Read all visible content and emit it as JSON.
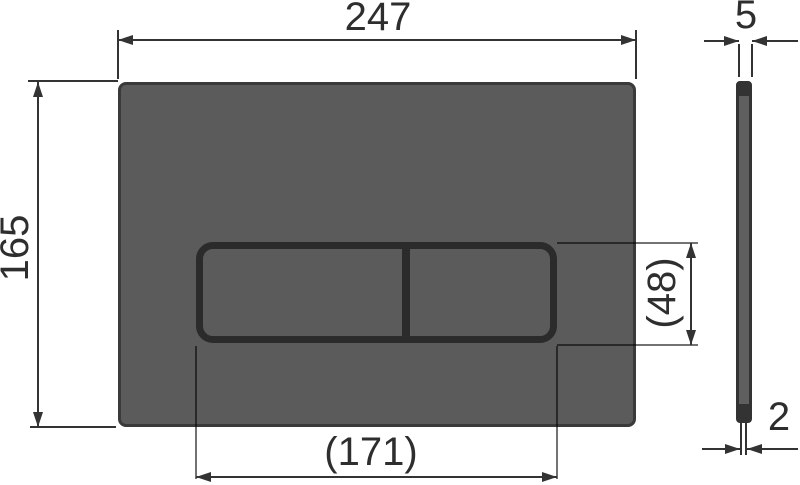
{
  "drawing": {
    "type": "technical-dimension-drawing",
    "subject": "WC flush plate with two buttons, front view and side view",
    "colors": {
      "background": "#ffffff",
      "plate_fill": "#5b5b5b",
      "plate_edge": "#3a3a3a",
      "button_stroke": "#2b2b2b",
      "dimension_line": "#333333",
      "text": "#2e2e2e"
    },
    "dimensions": {
      "plate_width": "247",
      "plate_height": "165",
      "button_area_width": "(171)",
      "button_area_height": "(48)",
      "thickness": "5",
      "button_protrusion": "2"
    }
  }
}
